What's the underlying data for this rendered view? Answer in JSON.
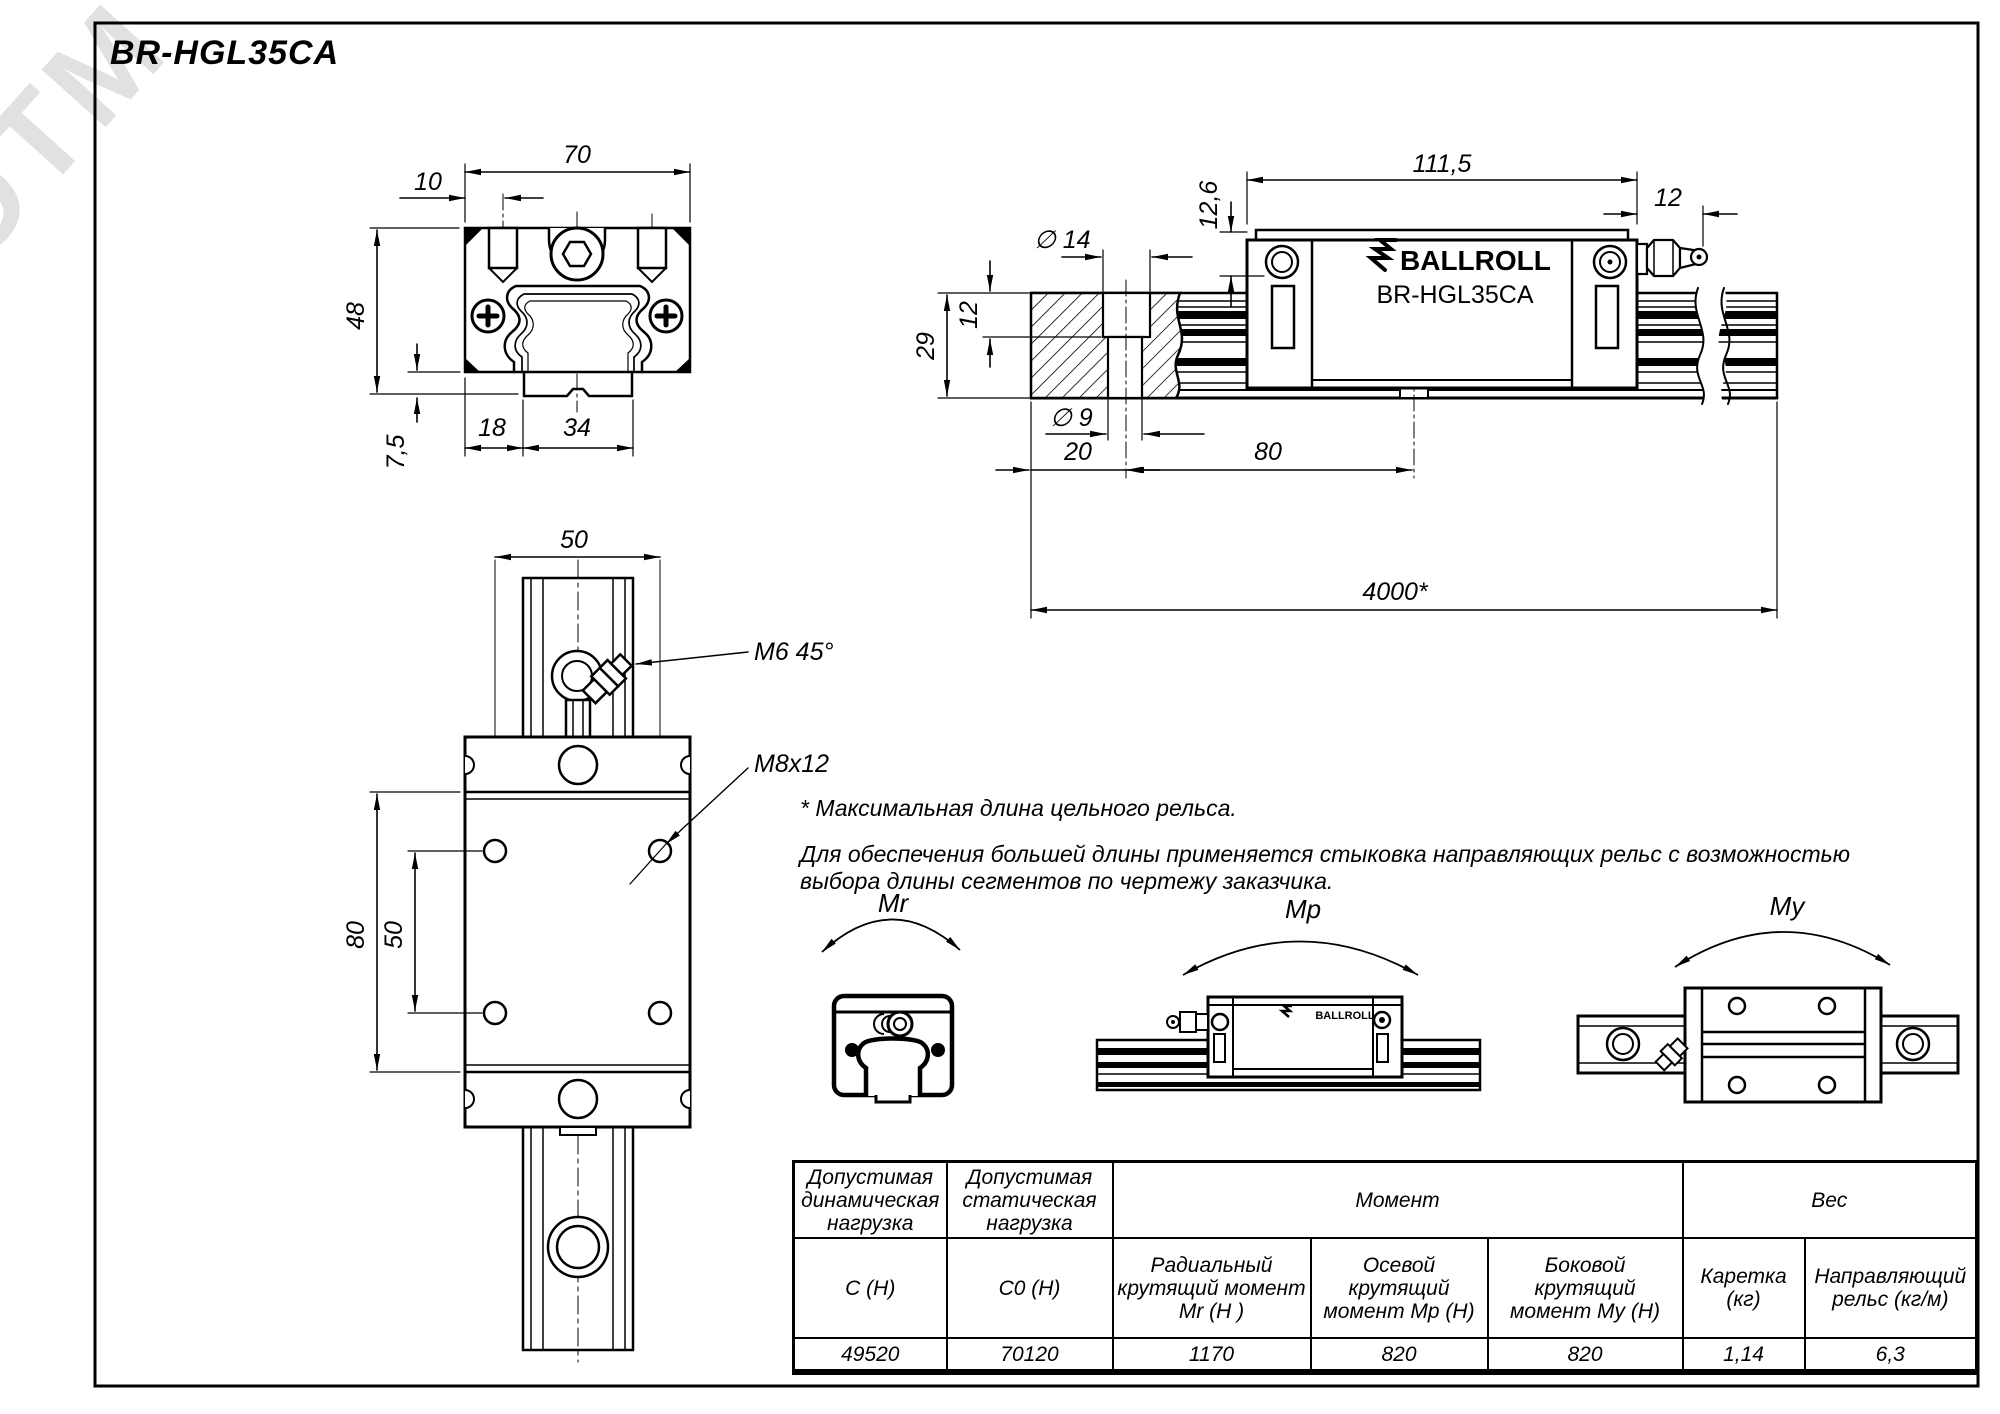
{
  "title": "BR-HGL35CA",
  "watermark": "ЭТМ",
  "brand": {
    "logo_text": "BALLROLL",
    "model": "BR-HGL35CA"
  },
  "front_view": {
    "dim_width": "70",
    "dim_offset": "10",
    "dim_height": "48",
    "dim_base": "7,5",
    "dim_left": "18",
    "dim_rail": "34"
  },
  "side_view": {
    "dim_h1": "12,6",
    "dim_length": "111,5",
    "dim_nipple": "12",
    "dim_cbore_dia": "∅ 14",
    "dim_cbore_depth": "12",
    "dim_rail_height": "29",
    "dim_hole_dia": "∅ 9",
    "dim_end": "20",
    "dim_pitch": "80",
    "dim_max_length": "4000*"
  },
  "plan_view": {
    "dim_rail_width": "50",
    "callout_nipple": "M6 45°",
    "callout_thread": "M8x12",
    "dim_length": "80",
    "dim_hole_pitch": "50"
  },
  "notes": {
    "line1": "* Максимальная длина цельного рельса.",
    "line2": "Для обеспечения большей длины применяется стыковка направляющих рельс с возможностью",
    "line3": "выбора длины сегментов по чертежу заказчика."
  },
  "moments": {
    "mr": "Mr",
    "mp": "Mp",
    "my": "My"
  },
  "table": {
    "h_dynamic": "Допустимая динамическая нагрузка",
    "h_static": "Допустимая статическая нагрузка",
    "h_moment": "Момент",
    "h_weight": "Вес",
    "sub": [
      "C (Н)",
      "C0 (Н)",
      "Радиальный крутящий момент Mr (Н )",
      "Осевой крутящий момент Mp (Н)",
      "Боковой крутящий момент My (Н)",
      "Каретка (кг)",
      "Направляющий рельс (кг/м)"
    ],
    "values": [
      "49520",
      "70120",
      "1170",
      "820",
      "820",
      "1,14",
      "6,3"
    ]
  }
}
